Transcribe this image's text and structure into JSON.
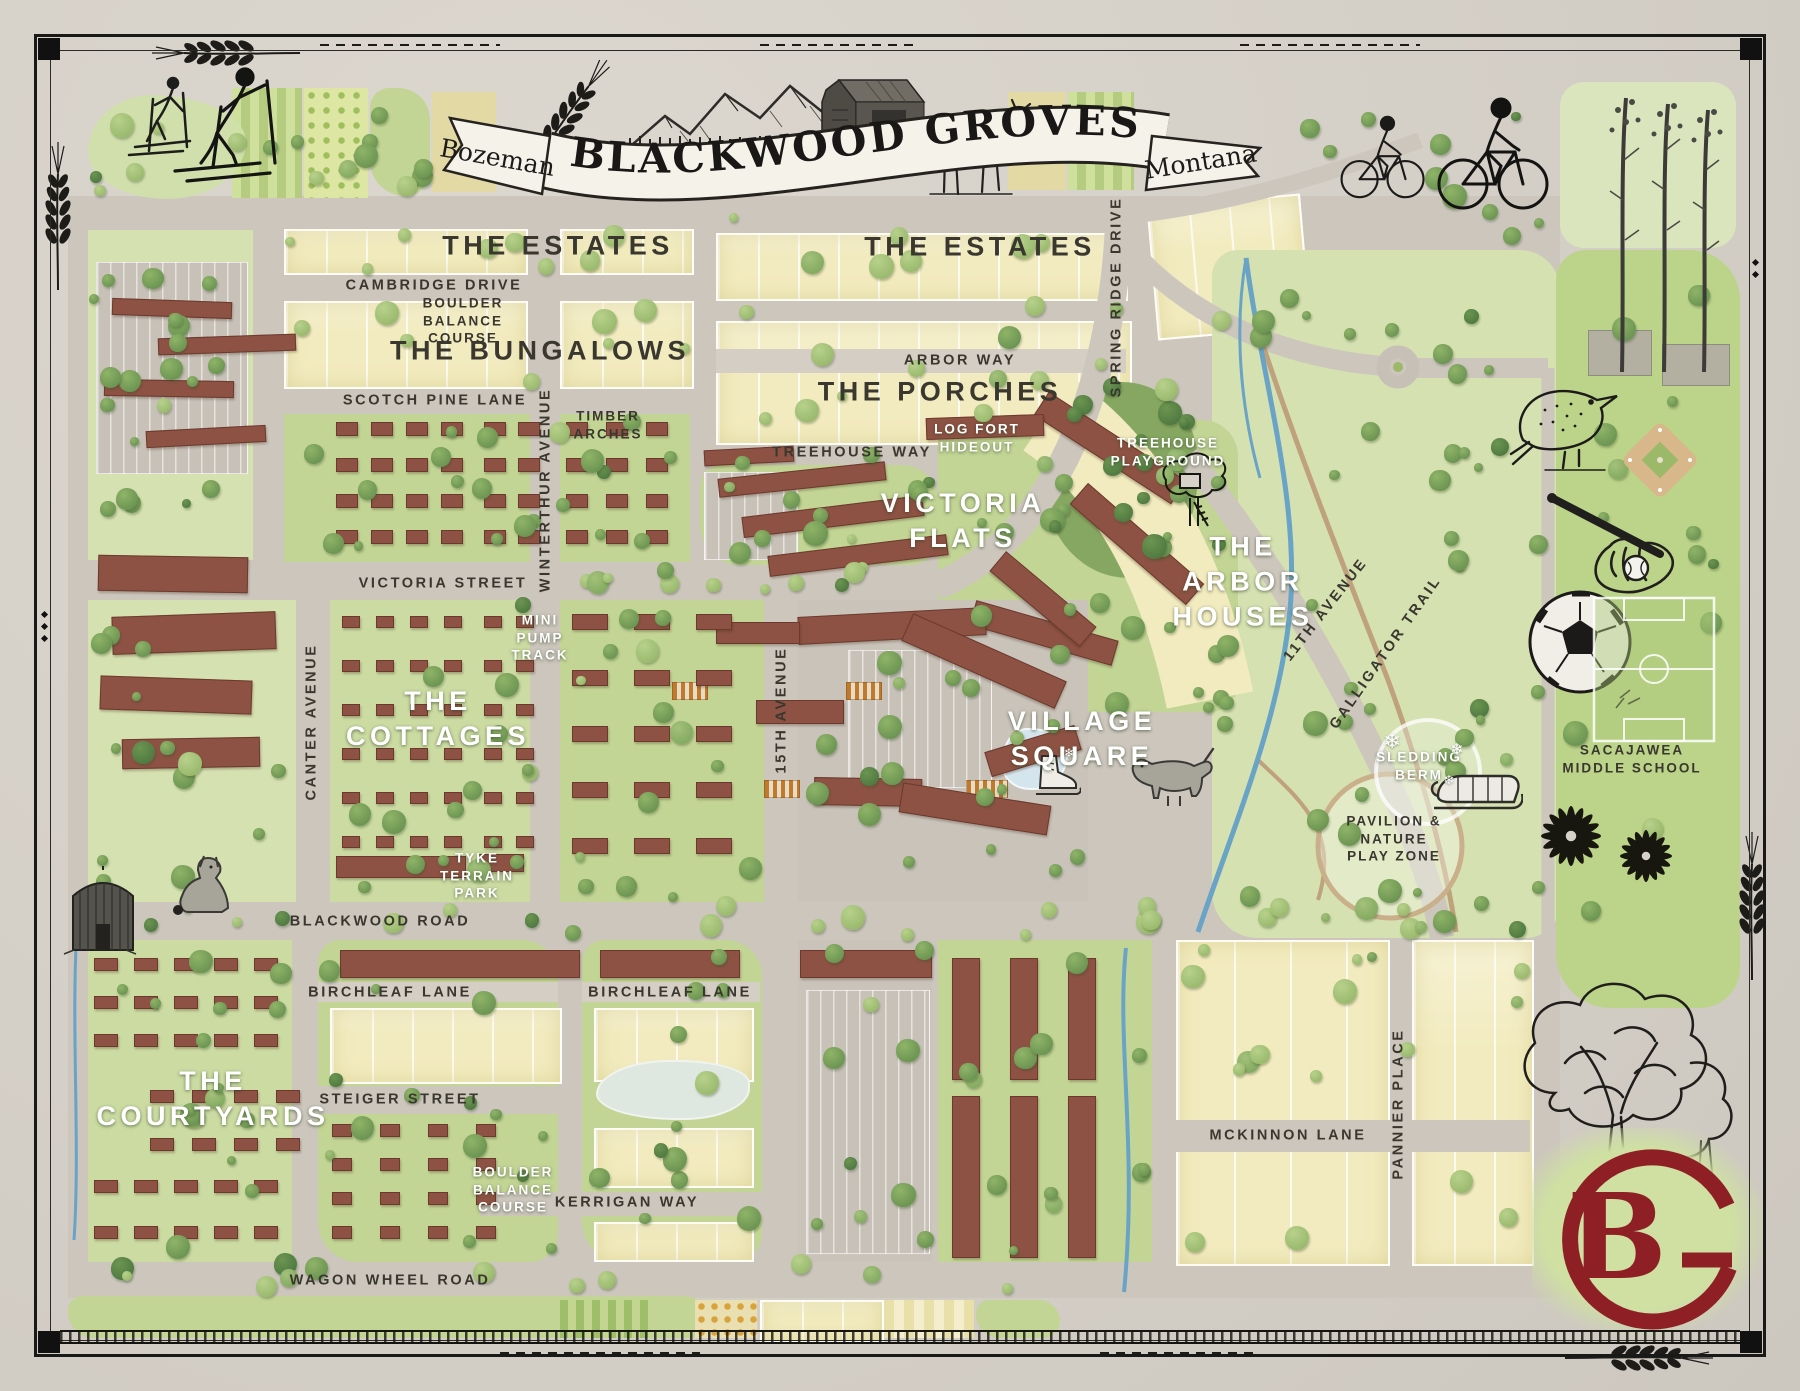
{
  "banner": {
    "title": "BLACKWOOD GROVES",
    "city": "Bozeman",
    "state": "Montana"
  },
  "logo": {
    "monogram": "BG",
    "letter_b": "B"
  },
  "colors": {
    "paper": "#d6d1c9",
    "road": "#ccc6bd",
    "lot_yellow": "#f2ebbf",
    "green_light": "#d5e1b0",
    "green_mid": "#c2d595",
    "green_park": "#cbdba2",
    "green_school": "#bcd489",
    "building_brown": "#8d5243",
    "creek_blue": "#69a3c6",
    "label_dark": "#3a372f",
    "label_white": "#ffffff",
    "logo_red": "#8e2025",
    "banner_cream": "#f5f2ea"
  },
  "labels": {
    "neighborhoods": [
      {
        "text": "THE ESTATES",
        "x": 558,
        "y": 246,
        "style": "dark"
      },
      {
        "text": "THE ESTATES",
        "x": 980,
        "y": 247,
        "style": "dark"
      },
      {
        "text": "THE BUNGALOWS",
        "x": 540,
        "y": 351,
        "style": "dark"
      },
      {
        "text": "THE PORCHES",
        "x": 940,
        "y": 392,
        "style": "dark"
      },
      {
        "text": "VICTORIA\nFLATS",
        "x": 963,
        "y": 521,
        "style": "white"
      },
      {
        "text": "THE\nARBOR\nHOUSES",
        "x": 1243,
        "y": 582,
        "style": "white"
      },
      {
        "text": "THE\nCOTTAGES",
        "x": 438,
        "y": 719,
        "style": "white"
      },
      {
        "text": "VILLAGE\nSQUARE",
        "x": 1082,
        "y": 739,
        "style": "white"
      },
      {
        "text": "THE\nCOURTYARDS",
        "x": 213,
        "y": 1099,
        "style": "white"
      }
    ],
    "streets": [
      {
        "text": "CAMBRIDGE DRIVE",
        "x": 434,
        "y": 286
      },
      {
        "text": "SCOTCH PINE LANE",
        "x": 435,
        "y": 401
      },
      {
        "text": "ARBOR WAY",
        "x": 960,
        "y": 361
      },
      {
        "text": "TREEHOUSE WAY",
        "x": 852,
        "y": 453
      },
      {
        "text": "VICTORIA STREET",
        "x": 443,
        "y": 584
      },
      {
        "text": "BLACKWOOD ROAD",
        "x": 380,
        "y": 922
      },
      {
        "text": "BIRCHLEAF LANE",
        "x": 390,
        "y": 993
      },
      {
        "text": "BIRCHLEAF LANE",
        "x": 670,
        "y": 993
      },
      {
        "text": "STEIGER STREET",
        "x": 400,
        "y": 1100
      },
      {
        "text": "KERRIGAN WAY",
        "x": 627,
        "y": 1203
      },
      {
        "text": "WAGON WHEEL ROAD",
        "x": 390,
        "y": 1281
      },
      {
        "text": "MCKINNON LANE",
        "x": 1288,
        "y": 1136
      },
      {
        "text": "WINTERTHUR AVENUE",
        "x": 546,
        "y": 490,
        "rot": -90
      },
      {
        "text": "CANTER AVENUE",
        "x": 312,
        "y": 722,
        "rot": -90
      },
      {
        "text": "15TH AVENUE",
        "x": 782,
        "y": 710,
        "rot": -90
      },
      {
        "text": "SPRING RIDGE DRIVE",
        "x": 1117,
        "y": 297,
        "rot": -90
      },
      {
        "text": "11TH AVENUE",
        "x": 1326,
        "y": 610,
        "rot": -52
      },
      {
        "text": "GALLIGATOR TRAIL",
        "x": 1386,
        "y": 653,
        "rot": -55
      },
      {
        "text": "PANNIER PLACE",
        "x": 1399,
        "y": 1104,
        "rot": -90
      }
    ],
    "amenities": [
      {
        "text": "BOULDER\nBALANCE\nCOURSE",
        "x": 463,
        "y": 321,
        "style": "dark"
      },
      {
        "text": "TIMBER\nARCHES",
        "x": 608,
        "y": 425,
        "style": "dark"
      },
      {
        "text": "LOG FORT\nHIDEOUT",
        "x": 977,
        "y": 438,
        "style": "white"
      },
      {
        "text": "TREEHOUSE\nPLAYGROUND",
        "x": 1168,
        "y": 452,
        "style": "white"
      },
      {
        "text": "MINI\nPUMP\nTRACK",
        "x": 540,
        "y": 638,
        "style": "white"
      },
      {
        "text": "TYKE\nTERRAIN\nPARK",
        "x": 477,
        "y": 876,
        "style": "white"
      },
      {
        "text": "SLEDDING\nBERM",
        "x": 1419,
        "y": 766,
        "style": "white"
      },
      {
        "text": "PAVILION &\nNATURE\nPLAY ZONE",
        "x": 1394,
        "y": 839,
        "style": "dark"
      },
      {
        "text": "SACAJAWEA\nMIDDLE SCHOOL",
        "x": 1632,
        "y": 759,
        "style": "dark"
      },
      {
        "text": "BOULDER\nBALANCE\nCOURSE",
        "x": 513,
        "y": 1190,
        "style": "white"
      }
    ]
  },
  "decorations": {
    "snowflake_icon": "❄",
    "snowflakes": [
      {
        "x": 1392,
        "y": 741,
        "size": 21
      },
      {
        "x": 1457,
        "y": 749,
        "size": 16
      },
      {
        "x": 1449,
        "y": 781,
        "size": 13
      },
      {
        "x": 1069,
        "y": 753,
        "size": 12
      }
    ]
  },
  "illustrations": [
    "cross-country-skiers",
    "barn",
    "deer",
    "mountain-range",
    "title-banner",
    "cyclists",
    "aspen-grove",
    "meadowlark-bird",
    "baseball-glove-and-bat",
    "soccer-ball",
    "baseball-diamond",
    "soccer-field",
    "wildflowers",
    "oak-trees",
    "grain-silo",
    "sitting-dog",
    "standing-dog",
    "tree-house",
    "sled",
    "ice-skate",
    "wheat-stalk",
    "railroad-track",
    "bg-monogram-logo"
  ]
}
